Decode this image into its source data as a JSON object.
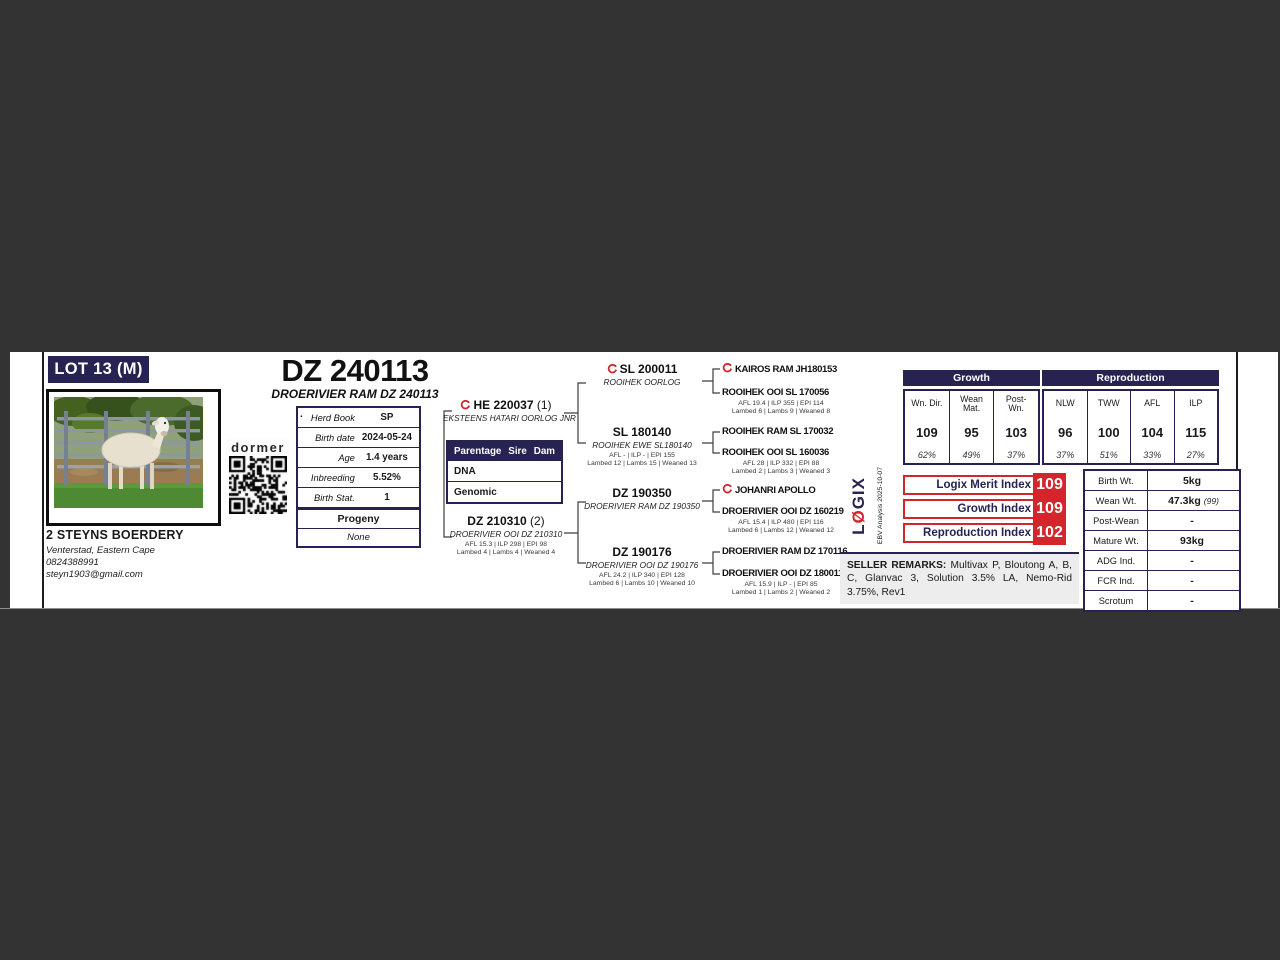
{
  "lot": {
    "label": "LOT 13 (M)"
  },
  "brand": {
    "logo": "dormer"
  },
  "breeder": {
    "name": "2 STEYNS BOERDERY",
    "location": "Venterstad, Eastern Cape",
    "phone": "0824388991",
    "email": "steyn1903@gmail.com"
  },
  "animal": {
    "id": "DZ 240113",
    "subtitle": "DROERIVIER RAM DZ 240113",
    "bullet": ".",
    "info": [
      {
        "label": "Herd Book",
        "value": "SP"
      },
      {
        "label": "Birth date",
        "value": "2024-05-24"
      },
      {
        "label": "Age",
        "value": "1.4 years"
      },
      {
        "label": "Inbreeding",
        "value": "5.52%"
      },
      {
        "label": "Birth Stat.",
        "value": "1"
      }
    ],
    "progeny": {
      "title": "Progeny",
      "value": "None"
    },
    "parentage": {
      "title": "Parentage",
      "sire": "Sire",
      "dam": "Dam",
      "rows": [
        "DNA",
        "Genomic"
      ]
    }
  },
  "pedigree": {
    "sire": {
      "id": "HE 220037",
      "suffix": "(1)",
      "name": "EKSTEENS HATARI OORLOG JNR"
    },
    "dam": {
      "id": "DZ 210310",
      "suffix": "(2)",
      "name": "DROERIVIER OOI DZ 210310",
      "ebv": "AFL 15.3 | ILP 298 | EPI 98",
      "lambing": "Lambed 4 | Lambs 4 | Weaned 4"
    },
    "sire_sire": {
      "id": "SL 200011",
      "name": "ROOIHEK OORLOG"
    },
    "sire_dam": {
      "id": "SL 180140",
      "name": "ROOIHEK EWE SL180140",
      "ebv": "AFL - | ILP - | EPI 155",
      "lambing": "Lambed 12 | Lambs 15 | Weaned 13"
    },
    "dam_sire": {
      "id": "DZ 190350",
      "name": "DROERIVIER RAM DZ 190350"
    },
    "dam_dam": {
      "id": "DZ 190176",
      "name": "DROERIVIER OOI DZ 190176",
      "ebv": "AFL 24.2 | ILP 340 | EPI 128",
      "lambing": "Lambed 6 | Lambs 10 | Weaned 10"
    },
    "g4": [
      {
        "id": "KAIROS RAM JH180153"
      },
      {
        "id": "ROOIHEK OOI SL 170056",
        "ebv": "AFL 19.4 | ILP 355 | EPI 114",
        "lambing": "Lambed 6 | Lambs 9 | Weaned 8"
      },
      {
        "id": "ROOIHEK RAM SL 170032"
      },
      {
        "id": "ROOIHEK OOI SL 160036",
        "ebv": "AFL 28 | ILP 332 | EPI 88",
        "lambing": "Lambed 2 | Lambs 3 | Weaned 3"
      },
      {
        "id": "JOHANRI APOLLO"
      },
      {
        "id": "DROERIVIER OOI DZ 160219",
        "ebv": "AFL 15.4 | ILP 480 | EPI 116",
        "lambing": "Lambed 6 | Lambs 12 | Weaned 12"
      },
      {
        "id": "DROERIVIER RAM DZ 170116"
      },
      {
        "id": "DROERIVIER OOI DZ 180011",
        "ebv": "AFL 15.9 | ILP - | EPI 85",
        "lambing": "Lambed 1 | Lambs 2 | Weaned 2"
      }
    ]
  },
  "ebv": {
    "growth": {
      "title": "Growth",
      "cols": [
        {
          "label": "Wn. Dir.",
          "value": "109",
          "acc": "62%"
        },
        {
          "label": "Wean Mat.",
          "value": "95",
          "acc": "49%"
        },
        {
          "label": "Post-Wn.",
          "value": "103",
          "acc": "37%"
        }
      ]
    },
    "reproduction": {
      "title": "Reproduction",
      "cols": [
        {
          "label": "NLW",
          "value": "96",
          "acc": "37%"
        },
        {
          "label": "TWW",
          "value": "100",
          "acc": "51%"
        },
        {
          "label": "AFL",
          "value": "104",
          "acc": "33%"
        },
        {
          "label": "ILP",
          "value": "115",
          "acc": "27%"
        }
      ]
    },
    "indexes": [
      {
        "label": "Logix Merit Index",
        "value": "109"
      },
      {
        "label": "Growth Index",
        "value": "109"
      },
      {
        "label": "Reproduction Index",
        "value": "102"
      }
    ],
    "logix": {
      "brand_l": "L",
      "brand_o": "Ø",
      "brand_rest": "GIX",
      "analysis": "EBV Analysis 2025-10-07"
    },
    "weights": [
      {
        "label": "Birth Wt.",
        "value": "5kg",
        "note": ""
      },
      {
        "label": "Wean Wt.",
        "value": "47.3kg",
        "note": "(99)"
      },
      {
        "label": "Post-Wean",
        "value": "-",
        "note": ""
      },
      {
        "label": "Mature Wt.",
        "value": "93kg",
        "note": ""
      },
      {
        "label": "ADG Ind.",
        "value": "-",
        "note": ""
      },
      {
        "label": "FCR Ind.",
        "value": "-",
        "note": ""
      },
      {
        "label": "Scrotum",
        "value": "-",
        "note": ""
      }
    ]
  },
  "remarks": {
    "label": "SELLER REMARKS:",
    "text": "Multivax P, Bloutong A, B, C, Glanvac 3, Solution 3.5% LA, Nemo-Rid 3.75%, Rev1"
  }
}
